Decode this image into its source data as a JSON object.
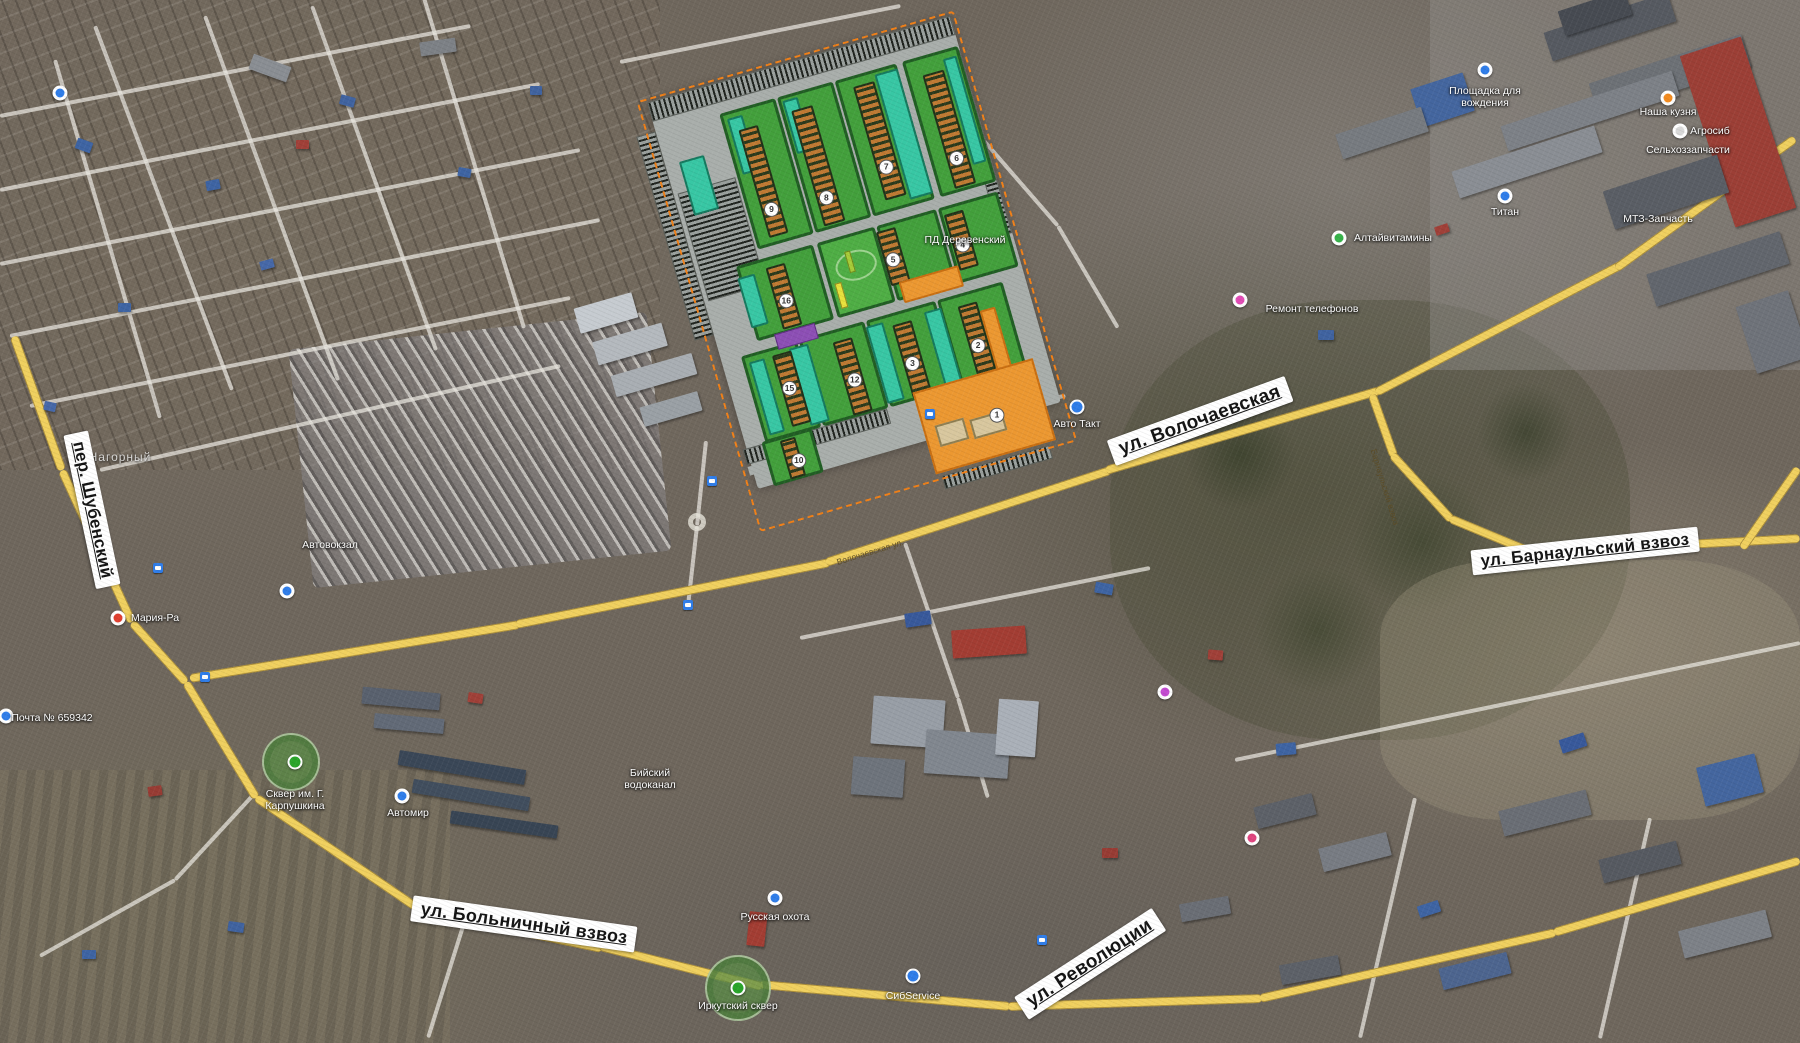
{
  "district": "Нагорный",
  "streets": {
    "volochaevskaya": "ул. Волочаевская",
    "barnaulsky": "ул. Барнаульский взвоз",
    "shubensky": "пер. Шубенский",
    "bolnichny": "ул. Больничный взвоз",
    "revolyutsii": "ул. Революции"
  },
  "road_names_small": {
    "barnaulsky": "Барнаульский взвоз",
    "volochaevskaya": "Волочаевская ул."
  },
  "pois": [
    {
      "label": "Площадка для вождения",
      "x": 1485,
      "y": 97,
      "icon": "blue",
      "ix": 0,
      "iy": -27,
      "w": 88
    },
    {
      "label": "Наша кузня",
      "x": 1668,
      "y": 112,
      "icon": "orange",
      "ix": 0,
      "iy": -14
    },
    {
      "label": "Агросиб",
      "x": 1710,
      "y": 131,
      "icon": "white",
      "ix": -30,
      "iy": 0
    },
    {
      "label": "Сельхоззапчасти",
      "x": 1688,
      "y": 150
    },
    {
      "label": "Титан",
      "x": 1505,
      "y": 212,
      "icon": "blue",
      "ix": 0,
      "iy": -16
    },
    {
      "label": "МТЗ-Запчасть",
      "x": 1658,
      "y": 219
    },
    {
      "label": "Алтайвитамины",
      "x": 1393,
      "y": 238,
      "icon": "green",
      "ix": -54,
      "iy": 0
    },
    {
      "label": "ПД Деревенский",
      "x": 965,
      "y": 240
    },
    {
      "label": "Ремонт телефонов",
      "x": 1312,
      "y": 309
    },
    {
      "label": "Авто Такт",
      "x": 1077,
      "y": 424,
      "icon": "car",
      "ix": 0,
      "iy": -17
    },
    {
      "label": "Автовокзал",
      "x": 330,
      "y": 545
    },
    {
      "label": "Мария-Ра",
      "x": 155,
      "y": 618,
      "icon": "red",
      "ix": -37,
      "iy": 0
    },
    {
      "label": "Почта № 659342",
      "x": 52,
      "y": 718,
      "icon": "blue",
      "ix": -46,
      "iy": -2
    },
    {
      "label": "Сквер им. Г. Карпушкина",
      "x": 295,
      "y": 800,
      "icon": "park",
      "ix": 0,
      "iy": -38,
      "w": 92
    },
    {
      "label": "Автомир",
      "x": 408,
      "y": 813,
      "icon": "blue",
      "ix": -6,
      "iy": -17
    },
    {
      "label": "Бийский водоканал",
      "x": 650,
      "y": 779,
      "w": 68
    },
    {
      "label": "Русская охота",
      "x": 775,
      "y": 917,
      "icon": "blue",
      "ix": 0,
      "iy": -19
    },
    {
      "label": "СибService",
      "x": 913,
      "y": 996,
      "icon": "car",
      "ix": 0,
      "iy": -20
    },
    {
      "label": "Иркутский сквер",
      "x": 738,
      "y": 1006,
      "icon": "park",
      "ix": 0,
      "iy": -18
    }
  ],
  "plan": {
    "units": [
      {
        "n": "9",
        "x": 110,
        "y": 137
      },
      {
        "n": "8",
        "x": 166,
        "y": 141
      },
      {
        "n": "7",
        "x": 232,
        "y": 128
      },
      {
        "n": "6",
        "x": 302,
        "y": 139
      },
      {
        "n": "5",
        "x": 213,
        "y": 219
      },
      {
        "n": "4",
        "x": 284,
        "y": 224
      },
      {
        "n": "16",
        "x": 99,
        "y": 229
      },
      {
        "n": "15",
        "x": 78,
        "y": 314
      },
      {
        "n": "12",
        "x": 143,
        "y": 324
      },
      {
        "n": "3",
        "x": 203,
        "y": 324
      },
      {
        "n": "2",
        "x": 271,
        "y": 325
      },
      {
        "n": "10",
        "x": 67,
        "y": 386
      },
      {
        "n": "1",
        "x": 270,
        "y": 397
      }
    ],
    "colors": {
      "block_green": "#43a03c",
      "park_green": "#4fae45",
      "courtyard_teal": "#38c7a4",
      "building_orange": "#c07a33",
      "zone_orange": "#ec9831",
      "purple_building": "#8d4fb5",
      "boundary_dash": "#f08018",
      "road_yellow": "#f0d05f"
    }
  }
}
